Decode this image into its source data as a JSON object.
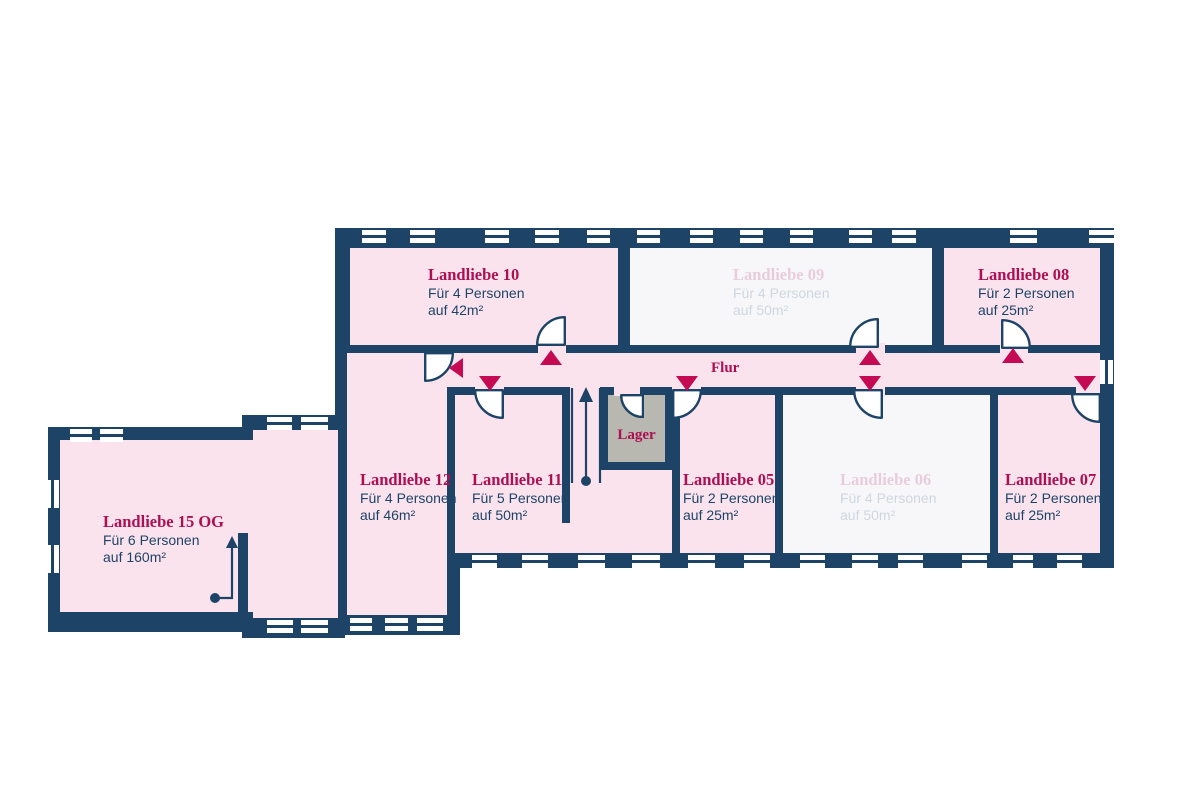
{
  "palette": {
    "wall_navy": "#1d4467",
    "room_pink": "#fbe3ee",
    "room_faded": "#f7f7fa",
    "accent_crimson": "#ae0f52",
    "triangle_magenta": "#c40a53",
    "lager_gray": "#b8b7b0",
    "background": "#ffffff"
  },
  "corridor": {
    "label": "Flur"
  },
  "storage": {
    "label": "Lager"
  },
  "rooms": [
    {
      "id": "landliebe-10",
      "name": "Landliebe 10",
      "capacity": "Für 4 Personen",
      "area": "auf 42m²",
      "state": "available"
    },
    {
      "id": "landliebe-09",
      "name": "Landliebe 09",
      "capacity": "Für 4 Personen",
      "area": "auf 50m²",
      "state": "faded"
    },
    {
      "id": "landliebe-08",
      "name": "Landliebe 08",
      "capacity": "Für 2 Personen",
      "area": "auf 25m²",
      "state": "available"
    },
    {
      "id": "landliebe-12",
      "name": "Landliebe 12",
      "capacity": "Für 4 Personen",
      "area": "auf 46m²",
      "state": "available"
    },
    {
      "id": "landliebe-11",
      "name": "Landliebe 11",
      "capacity": "Für 5 Personen",
      "area": "auf 50m²",
      "state": "available"
    },
    {
      "id": "landliebe-05",
      "name": "Landliebe 05",
      "capacity": "Für 2 Personen",
      "area": "auf 25m²",
      "state": "available"
    },
    {
      "id": "landliebe-06",
      "name": "Landliebe 06",
      "capacity": "Für 4 Personen",
      "area": "auf 50m²",
      "state": "faded"
    },
    {
      "id": "landliebe-07",
      "name": "Landliebe 07",
      "capacity": "Für 2 Personen",
      "area": "auf 25m²",
      "state": "available"
    },
    {
      "id": "landliebe-15-og",
      "name": "Landliebe 15 OG",
      "capacity": "Für 6 Personen",
      "area": "auf 160m²",
      "state": "available"
    }
  ]
}
